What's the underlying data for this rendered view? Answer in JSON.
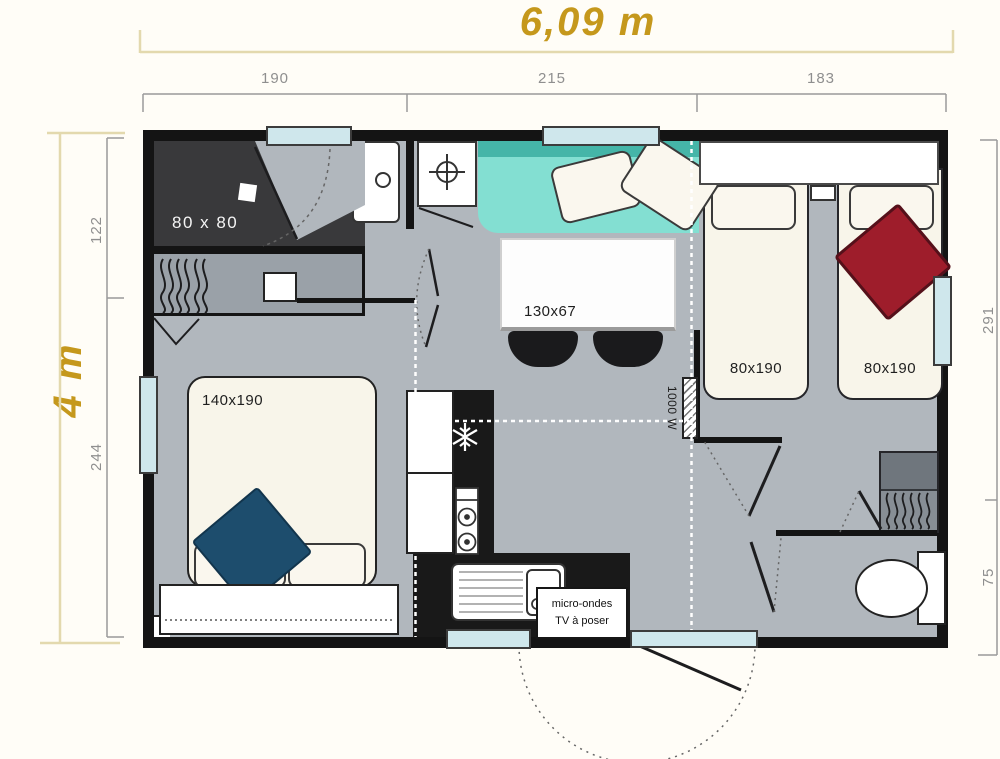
{
  "title": {
    "width": "6,09 m",
    "height": "4 m"
  },
  "dimensions": {
    "top": [
      "190",
      "215",
      "183"
    ],
    "left": [
      "122",
      "244"
    ],
    "right": [
      "291",
      "75"
    ]
  },
  "labels": {
    "shower": "80 x 80",
    "table": "130x67",
    "master_bed": "140x190",
    "bed_left": "80x190",
    "bed_right": "80x190",
    "heater": "1000 W",
    "kitchen_note_1": "micro-ondes",
    "kitchen_note_2": "TV à poser"
  },
  "colors": {
    "accent_gold": "#c5981c",
    "dim_line_gold": "#e3d9ae",
    "dim_text_gray": "#8f8f8f",
    "floor_gray": "#b1b7bd",
    "wall_black": "#141414",
    "shower_dark": "#39393b",
    "wardrobe_gray": "#9aa1a8",
    "sofa_teal": "#83dfd2",
    "sofa_teal_dark": "#45b5a8",
    "bed_cream": "#f8f5ea",
    "cushion_red": "#9e1d2b",
    "cushion_blue": "#1d4d6d",
    "window_blue": "#cfe7ec",
    "counter_black": "#191919"
  }
}
